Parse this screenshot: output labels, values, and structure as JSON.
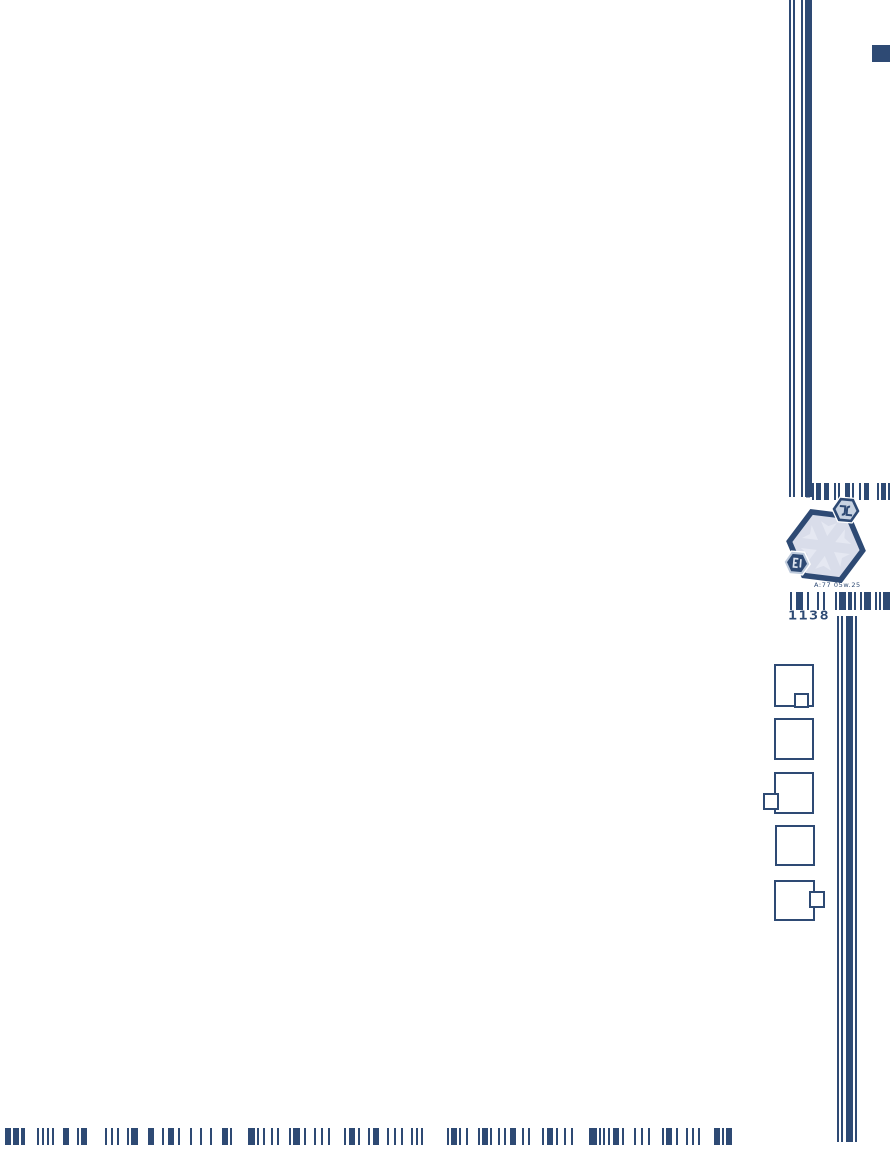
{
  "colors": {
    "navy": "#2e4a74",
    "hex_fill": "#d9ddea",
    "hex_pattern": "#e5e8f2",
    "satellite_light_fill": "#c8d3e2",
    "satellite_ring": "#bfcbdc",
    "background": "#ffffff"
  },
  "logo": {
    "code_label": "1138",
    "caption": "A:77 05w.25",
    "block_label": "block 08-23"
  },
  "decor": {
    "corner_square": {
      "x": 872,
      "y": 45,
      "w": 18,
      "h": 17
    },
    "top_lines": {
      "x": 789,
      "y": 0,
      "w": 23,
      "h": 497,
      "stripes": [
        [
          0,
          2
        ],
        [
          4,
          2
        ],
        [
          12,
          2
        ],
        [
          16,
          7
        ]
      ]
    },
    "bottom_lines": {
      "x": 837,
      "y": 616,
      "w": 20,
      "h": 526,
      "stripes": [
        [
          0,
          2
        ],
        [
          4,
          2
        ],
        [
          9,
          7
        ],
        [
          18,
          2
        ]
      ]
    },
    "barcodes": {
      "top": {
        "x": 812,
        "y": 483,
        "w": 79,
        "h": 17,
        "pattern": [
          2,
          -2,
          5,
          -3,
          5,
          -5,
          2,
          -2,
          2,
          -5,
          5,
          -2,
          2,
          -5,
          2,
          -3,
          5,
          -8,
          2,
          -2,
          5,
          -2,
          2,
          -3,
          6
        ]
      },
      "mid": {
        "x": 790,
        "y": 592,
        "w": 101,
        "h": 18,
        "pattern": [
          2,
          -4,
          7,
          -4,
          2,
          -8,
          2,
          -4,
          2,
          -10,
          2,
          -2,
          7,
          -2,
          4,
          -2,
          2,
          -4,
          2,
          -2,
          7,
          -4,
          2,
          -2,
          2,
          -2,
          7,
          -2,
          2,
          -2,
          4
        ]
      },
      "bottom": {
        "x": 5,
        "y": 1128,
        "w": 768,
        "h": 17,
        "pattern": [
          6,
          -2,
          6,
          -2,
          4,
          -12,
          2,
          -3,
          2,
          -3,
          2,
          -3,
          2,
          -9,
          6,
          -8,
          2,
          -2,
          6,
          -18,
          2,
          -4,
          2,
          -4,
          2,
          -8,
          2,
          -2,
          7,
          -10,
          6,
          -8,
          2,
          -4,
          6,
          -4,
          2,
          -10,
          2,
          -8,
          2,
          -8,
          2,
          -10,
          6,
          -2,
          2,
          -16,
          7,
          -2,
          2,
          -4,
          2,
          -6,
          2,
          -4,
          2,
          -10,
          2,
          -2,
          7,
          -4,
          2,
          -8,
          2,
          -5,
          2,
          -5,
          2,
          -14,
          2,
          -3,
          6,
          -3,
          2,
          -8,
          2,
          -3,
          6,
          -8,
          2,
          -5,
          2,
          -5,
          2,
          -8,
          2,
          -3,
          2,
          -3,
          2,
          -24,
          2,
          -2,
          6,
          -2,
          2,
          -5,
          2,
          -10,
          2,
          -2,
          6,
          -2,
          2,
          -6,
          2,
          -4,
          2,
          -4,
          6,
          -6,
          2,
          -4,
          2,
          -12,
          2,
          -3,
          6,
          -3,
          2,
          -6,
          2,
          -5,
          2,
          -16,
          8,
          -2,
          2,
          -2,
          2,
          -3,
          2,
          -3,
          6,
          -3,
          2,
          -10,
          2,
          -5,
          2,
          -5,
          2,
          -12,
          2,
          -2,
          6,
          -4,
          2,
          -8,
          2,
          -4,
          2,
          -4,
          2,
          -14,
          6,
          -2,
          2,
          -2,
          6
        ]
      }
    },
    "squares": [
      {
        "x": 774,
        "y": 664,
        "w": 40,
        "h": 43,
        "sat": {
          "x": 794,
          "y": 693,
          "w": 15,
          "h": 15
        }
      },
      {
        "x": 774,
        "y": 718,
        "w": 40,
        "h": 42,
        "sat": null
      },
      {
        "x": 774,
        "y": 772,
        "w": 40,
        "h": 42,
        "sat": {
          "x": 763,
          "y": 793,
          "w": 16,
          "h": 17
        }
      },
      {
        "x": 775,
        "y": 825,
        "w": 40,
        "h": 41,
        "sat": null
      },
      {
        "x": 774,
        "y": 880,
        "w": 41,
        "h": 41,
        "sat": {
          "x": 809,
          "y": 891,
          "w": 16,
          "h": 17
        }
      }
    ]
  }
}
